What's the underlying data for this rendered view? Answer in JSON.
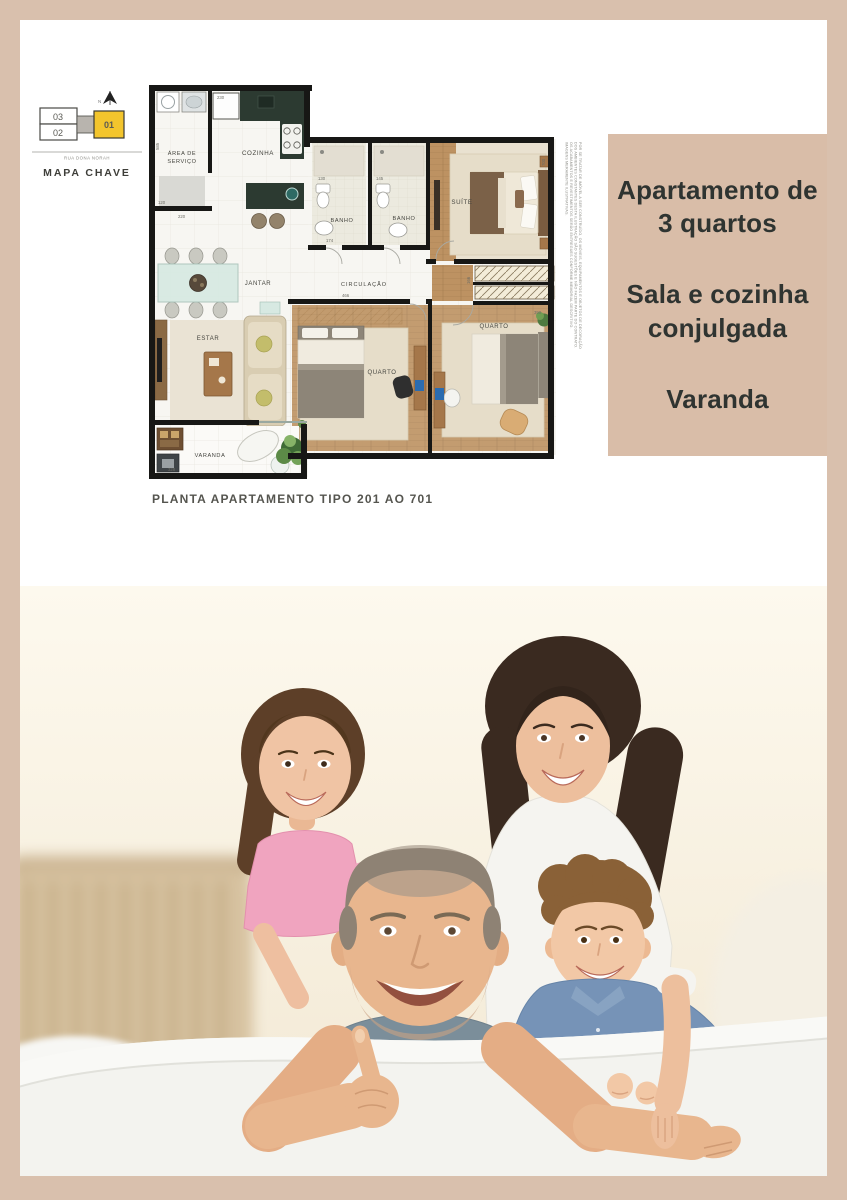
{
  "page": {
    "border_color": "#d9c0ad",
    "content_bg": "#ffffff"
  },
  "mapa": {
    "title": "MAPA CHAVE",
    "street": "RUA DONA NORAH",
    "units": {
      "u03": "03",
      "u02": "02",
      "u01": "01"
    },
    "highlight_color": "#f3c52d"
  },
  "plan": {
    "caption": "PLANTA APARTAMENTO TIPO 201 AO 701",
    "rooms": {
      "servico_l1": "ÁREA DE",
      "servico_l2": "SERVIÇO",
      "cozinha": "COZINHA",
      "banho1": "BANHO",
      "banho2": "BANHO",
      "suite": "SUÍTE",
      "jantar": "JANTAR",
      "circulacao": "CIRCULAÇÃO",
      "estar": "ESTAR",
      "quarto1": "QUARTO",
      "quarto2": "QUARTO",
      "varanda": "VARANDA"
    },
    "dims": {
      "fridge": "230",
      "servico_h": "120",
      "servico_w": "220",
      "servico_side": "585",
      "banho1": "130",
      "banho2": "145",
      "banho1_w": "174",
      "suite_side": "700",
      "hall_side": "166",
      "hall_w": "466",
      "quarto2_w": "390",
      "varanda_w": "328"
    },
    "disclaimer": [
      "POR SE TRATAR DE IMÓVEL A SER CONSTRUÍDO, OS MÓVEIS, EQUIPAMENTOS E OBJETOS DE DECORAÇÃO",
      "DOS AMBIENTES CONSTANTES DESTA ILUSTRAÇÃO SÃO SUGESTÕES E NÃO FAZEM PARTE DO CONTRATO.",
      "OS ACABAMENTOS E REVESTIMENTOS SERÃO ENTREGUES CONFORME MEMORIAL DESCRITIVO.",
      "IMAGENS MERAMENTE ILUSTRATIVAS."
    ]
  },
  "infobox": {
    "bg": "#d9bda8",
    "text_color": "#2f3431",
    "lines": [
      "Apartamento de 3 quartos",
      "Sala e cozinha conjulgada",
      "Varanda"
    ]
  },
  "photo_palette": {
    "background": "#f9f1e0",
    "sofa": "#f3f3ef",
    "skin": "#e8b68e",
    "father_shirt": "#7b8e9a",
    "mother_top": "#f5f4f0",
    "girl_shirt": "#f0a4bf",
    "boy_shirt": "#7693b7",
    "wicker": "#d7c2a0"
  }
}
